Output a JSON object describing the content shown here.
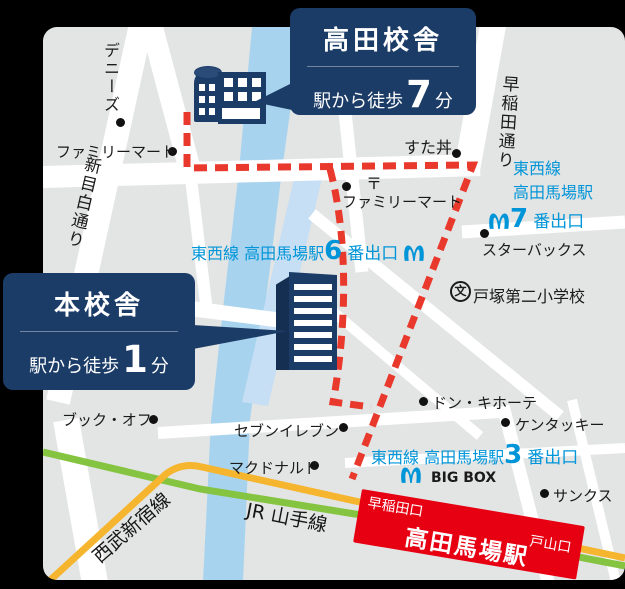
{
  "callouts": {
    "takada": {
      "title": "高田校舎",
      "walk_prefix": "駅から徒歩",
      "walk_num": "7",
      "walk_suffix": "分"
    },
    "honkosha": {
      "title": "本校舎",
      "walk_prefix": "駅から徒歩",
      "walk_num": "1",
      "walk_suffix": "分"
    }
  },
  "station": {
    "name": "高田馬場駅",
    "exit_waseda": "早稲田口",
    "exit_toyama": "戸山口"
  },
  "exits": {
    "exit7": {
      "line1": "東西線",
      "line2": "高田馬場駅",
      "num": "7",
      "suffix": "番出口"
    },
    "exit6": {
      "prefix": "東西線 高田馬場駅",
      "num": "6",
      "suffix": "番出口"
    },
    "exit3": {
      "prefix": "東西線 高田馬場駅",
      "num": "3",
      "suffix": "番出口"
    }
  },
  "pois": {
    "dennys": "デニーズ",
    "familymart1": "ファミリーマート",
    "sutadon": "すた丼",
    "postmark": "〒",
    "familymart2": "ファミリーマート",
    "starbucks": "スターバックス",
    "school_mark": "文",
    "school": "戸塚第二小学校",
    "donki": "ドン・キホーテ",
    "kfc": "ケンタッキー",
    "sunkus": "サンクス",
    "bookoff": "ブック・オフ",
    "seveneleven": "セブンイレブン",
    "mcdonalds": "マクドナルド",
    "bigbox": "BIG BOX"
  },
  "roads": {
    "shinmejiro": "新目白通り",
    "waseda_dori": "早稲田通り"
  },
  "rails": {
    "jr_yamanote": "JR 山手線",
    "seibu_shinjuku": "西武新宿線"
  },
  "colors": {
    "navy": "#1c3c68",
    "map_bg": "#e3e4e4",
    "river": "#a8d3ef",
    "route_red": "#e8392c",
    "station_red": "#e60012",
    "metro_blue": "#0095d8",
    "jr_green": "#85c440",
    "seibu_yellow": "#f6b52e"
  }
}
